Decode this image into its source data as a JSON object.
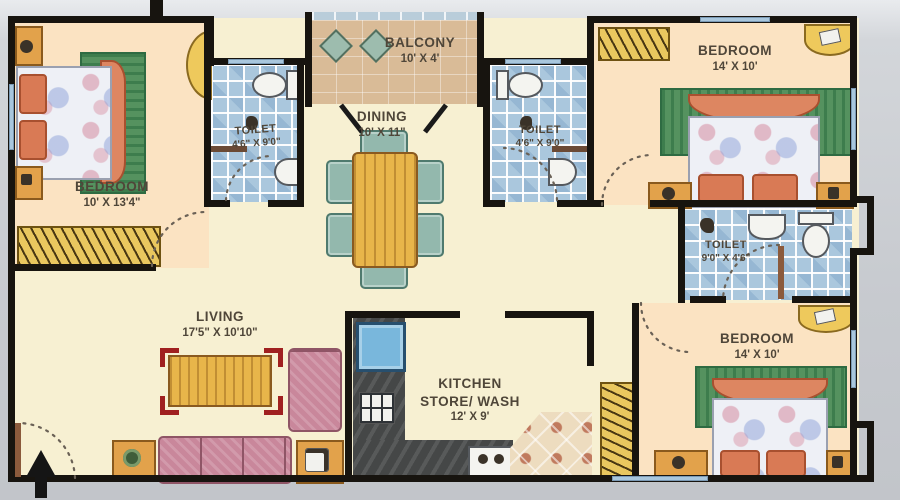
{
  "plan": {
    "rooms": {
      "bedroom_left": {
        "label": "BEDROOM",
        "dims": "10' X 13'4\""
      },
      "toilet_left": {
        "label": "TOILET",
        "dims": "4'6\" X 9'0\""
      },
      "balcony": {
        "label": "BALCONY",
        "dims": "10' X 4'"
      },
      "dining": {
        "label": "DINING",
        "dims": "10' X 11\""
      },
      "toilet_center": {
        "label": "TOILET",
        "dims": "4'6\" X 9'0\""
      },
      "bedroom_top_right": {
        "label": "BEDROOM",
        "dims": "14' X 10'"
      },
      "toilet_right": {
        "label": "TOILET",
        "dims": "9'0\" X 4'6\""
      },
      "bedroom_bottom_right": {
        "label": "BEDROOM",
        "dims": "14' X 10'"
      },
      "living": {
        "label": "LIVING",
        "dims": "17'5\" X 10'10\""
      },
      "kitchen": {
        "label": "KITCHEN",
        "label2": "STORE/ WASH",
        "dims": "12' X 9'"
      }
    },
    "colors": {
      "wall": "#17140f",
      "floor_cream": "#f7f0d2",
      "floor_peach": "#fbe3c2",
      "toilet_tile_blue": "#aac7dd",
      "balcony_tan": "#d9bb97",
      "wood_orange": "#e2a24b",
      "wardrobe_yellow": "#e9c75f",
      "bed_frame_salmon": "#dd8661",
      "rug_green": "#55925f",
      "sofa_pink": "#c9879b",
      "chair_teal": "#93b8ad",
      "counter_dark": "#454747",
      "sink_blue": "#79b7dc",
      "window_blue": "#a9c7dd",
      "label_text": "#4f4639"
    }
  }
}
